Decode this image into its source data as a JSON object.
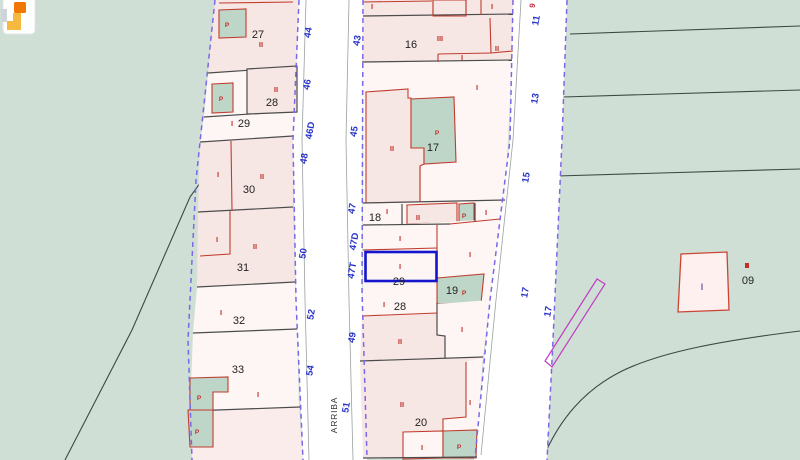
{
  "app": {
    "logo_tooltip": "Catastro"
  },
  "street": {
    "name": "ARRIBA"
  },
  "highlighted_parcel": {
    "number": "29",
    "color": "#1515cd"
  },
  "parcel_numbers": {
    "left": [
      "27",
      "28",
      "29",
      "30",
      "31",
      "32",
      "33"
    ],
    "middle": [
      "16",
      "17",
      "18",
      "29",
      "19",
      "28",
      "20"
    ],
    "right": [
      "09"
    ]
  },
  "street_numbers": {
    "even_side": [
      "44",
      "46",
      "46D",
      "48",
      "50",
      "52",
      "54"
    ],
    "odd_side": [
      "43",
      "45",
      "47",
      "47D",
      "47T",
      "49",
      "51"
    ],
    "avenue": [
      "11",
      "13",
      "15",
      "17",
      "17"
    ],
    "avenue_partial": "9"
  },
  "annotations": {
    "roman_i": "I",
    "roman_ii": "II",
    "roman_iii": "III",
    "pool": "P"
  },
  "colors": {
    "background": "#cfdfd5",
    "road": "#ffffff",
    "parcel_pink": "#f7e7e4",
    "parcel_light": "#fdf6f4",
    "patch_green": "#bdd6c8",
    "boundary_dark": "#4c4c4c",
    "boundary_red": "#c03c2e",
    "boundary_purple": "#7b68e8",
    "highlight_blue": "#1515cd",
    "street_number_blue": "#2631c8",
    "sliver_magenta": "#c23bc2",
    "logo_orange": "#f07800",
    "logo_amber": "#f5b940"
  }
}
